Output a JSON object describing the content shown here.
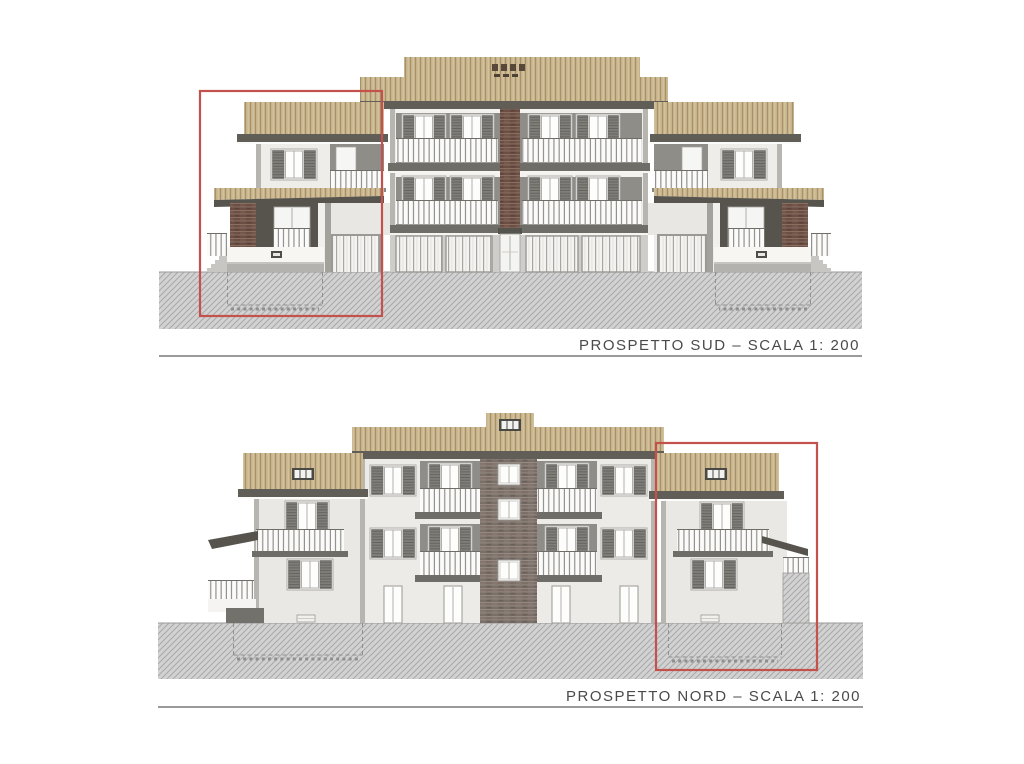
{
  "sheet": {
    "background": "#ffffff"
  },
  "drawings": {
    "sud": {
      "label": "PROSPETTO SUD – SCALA 1: 200",
      "highlighted_unit": "left"
    },
    "nord": {
      "label": "PROSPETTO NORD – SCALA 1: 200",
      "highlighted_unit": "right"
    }
  },
  "colors": {
    "sheet_bg": "#ffffff",
    "highlight_red": "#c4524c",
    "roof_base": "#c7b28a",
    "roof_line_dark": "#a5916c",
    "roof_line_light": "#d9cca9",
    "eave": "#615e57",
    "wall_light": "#efede9",
    "wall_side": "#b7b5b0",
    "recess_gray": "#8f8d88",
    "slab_dark": "#6f6d67",
    "brick_south": "#6b4f45",
    "brick_north": "#7b6f6a",
    "ground_fill": "#d2d2d2",
    "ground_line": "#aaaaaa",
    "label_text": "#4a4a4a"
  }
}
